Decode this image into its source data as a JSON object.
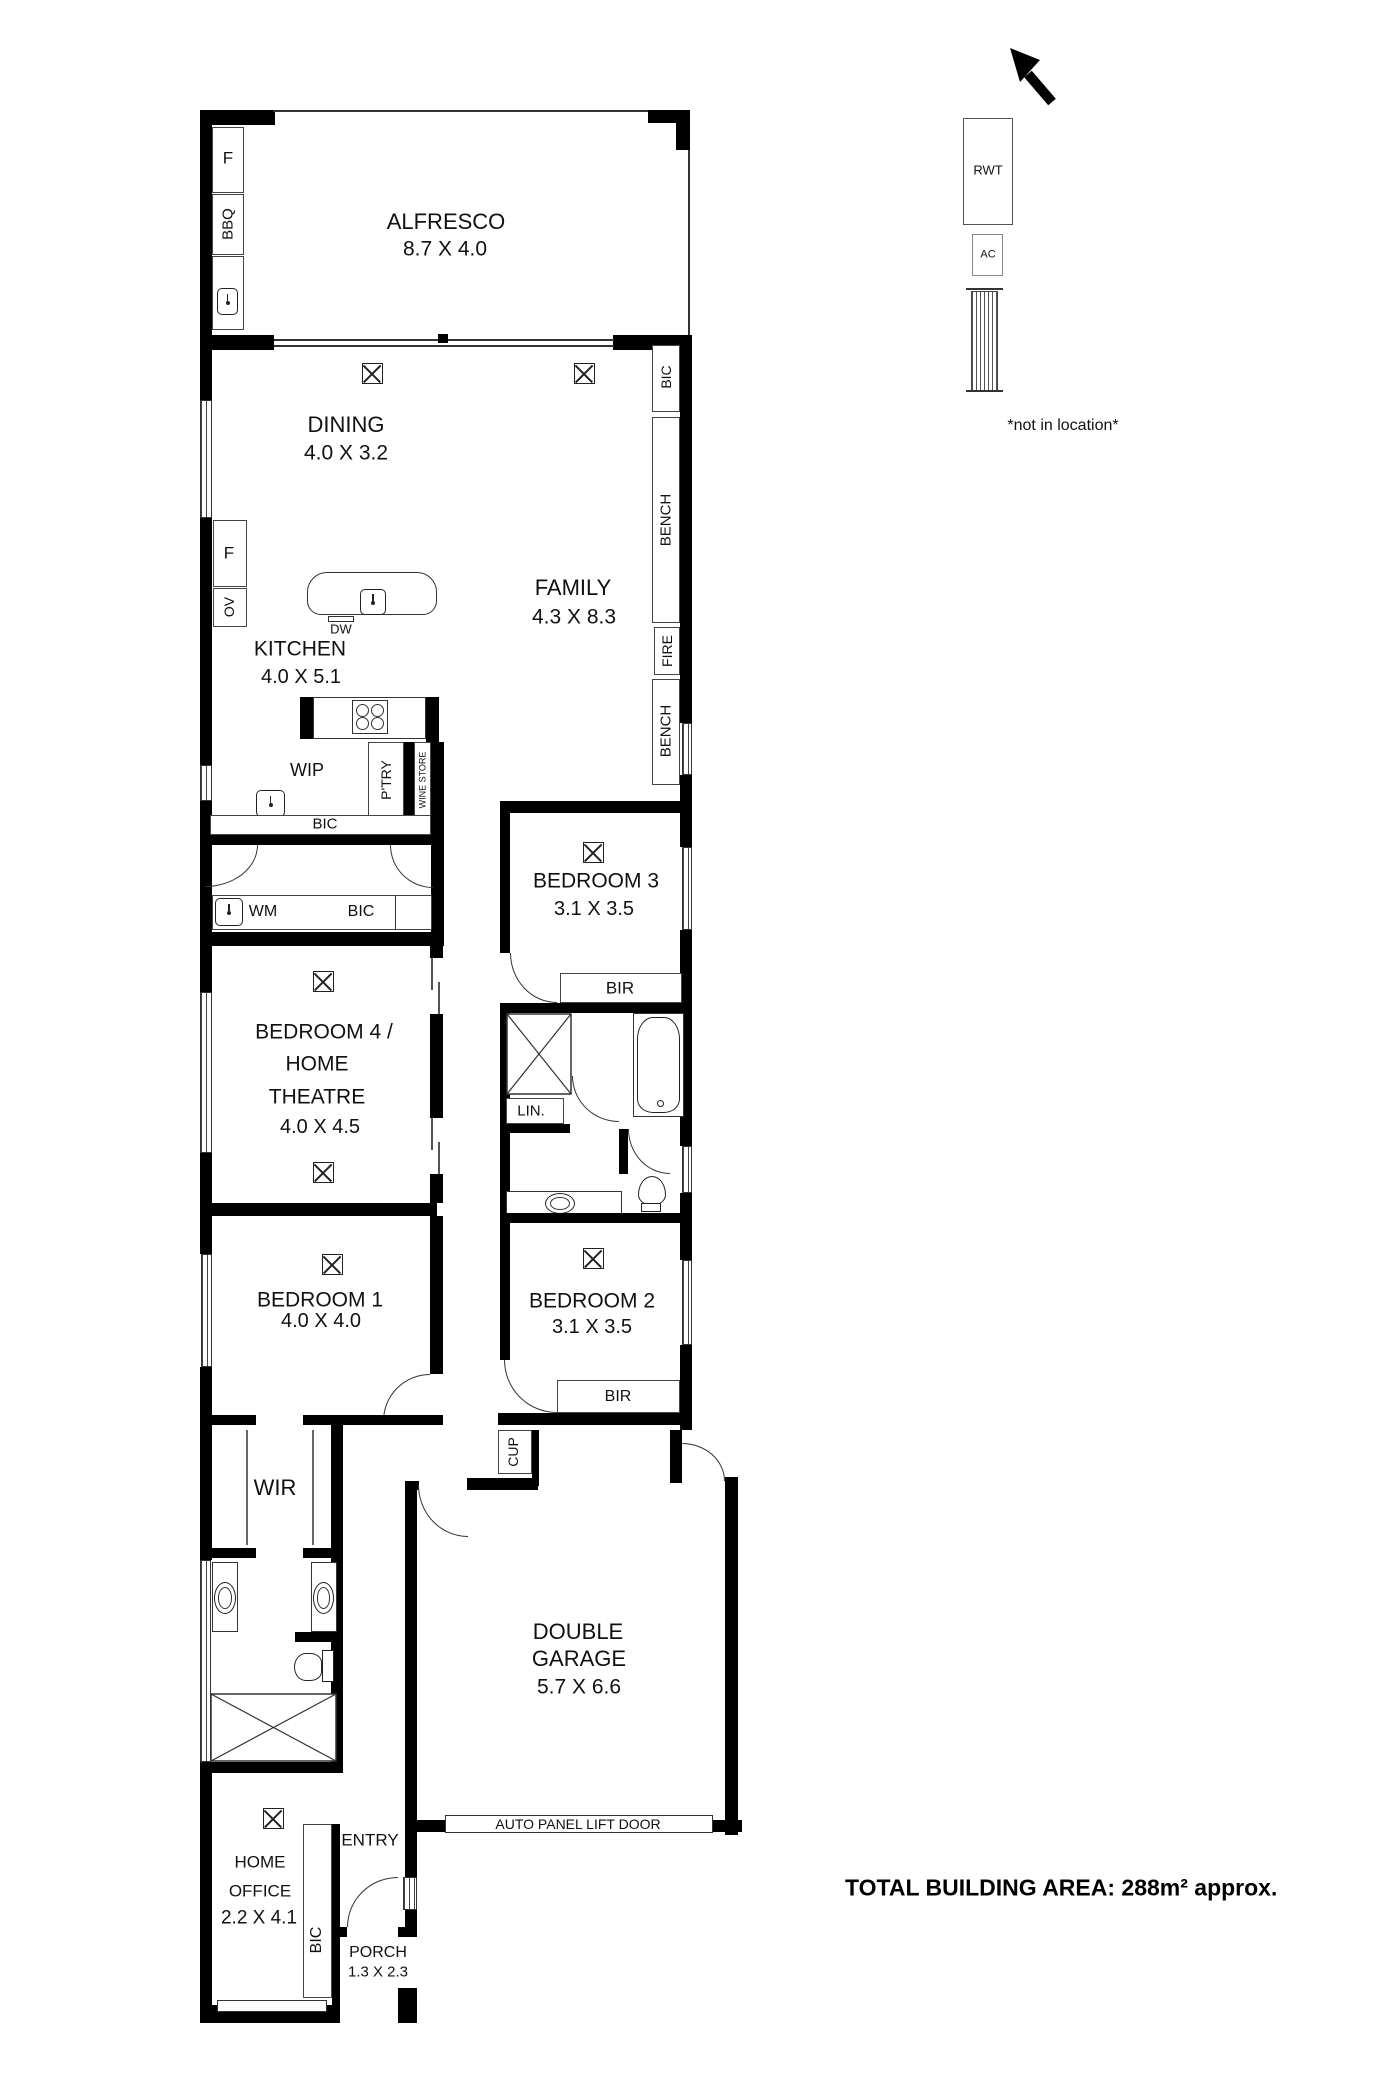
{
  "rooms": {
    "alfresco": {
      "name": "ALFRESCO",
      "dims": "8.7 X 4.0"
    },
    "dining": {
      "name": "DINING",
      "dims": "4.0 X 3.2"
    },
    "family": {
      "name": "FAMILY",
      "dims": "4.3 X 8.3"
    },
    "kitchen": {
      "name": "KITCHEN",
      "dims": "4.0 X 5.1"
    },
    "wip": {
      "name": "WIP"
    },
    "bedroom3": {
      "name": "BEDROOM 3",
      "dims": "3.1 X 3.5"
    },
    "bedroom4": {
      "line1": "BEDROOM 4 /",
      "line2": "HOME",
      "line3": "THEATRE",
      "dims": "4.0 X 4.5"
    },
    "bedroom1": {
      "name": "BEDROOM 1",
      "dims": "4.0 X 4.0"
    },
    "bedroom2": {
      "name": "BEDROOM 2",
      "dims": "3.1 X 3.5"
    },
    "wir": {
      "name": "WIR"
    },
    "garage": {
      "line1": "DOUBLE",
      "line2": "GARAGE",
      "dims": "5.7 X 6.6"
    },
    "home_office": {
      "line1": "HOME",
      "line2": "OFFICE",
      "dims": "2.2 X 4.1"
    },
    "entry": {
      "name": "ENTRY"
    },
    "porch": {
      "name": "PORCH",
      "dims": "1.3 X 2.3"
    }
  },
  "fixtures": {
    "f_alfresco": "F",
    "bbq": "BBQ",
    "f_kitchen": "F",
    "ov": "OV",
    "dw": "DW",
    "ptry": "P'TRY",
    "wine_store": "WINE STORE",
    "bic_dining": "BIC",
    "bench_upper": "BENCH",
    "fire": "FIRE",
    "bench_lower": "BENCH",
    "bic_kitchen": "BIC",
    "wm": "WM",
    "bic_laundry": "BIC",
    "bir_bed3": "BIR",
    "lin": "LIN.",
    "bir_bed2": "BIR",
    "cup": "CUP",
    "bic_entry": "BIC"
  },
  "annotations": {
    "garage_door": "AUTO PANEL LIFT DOOR",
    "rwt": "RWT",
    "ac": "AC",
    "not_in_location": "*not in location*",
    "total_area": "TOTAL BUILDING AREA: 288m² approx."
  }
}
